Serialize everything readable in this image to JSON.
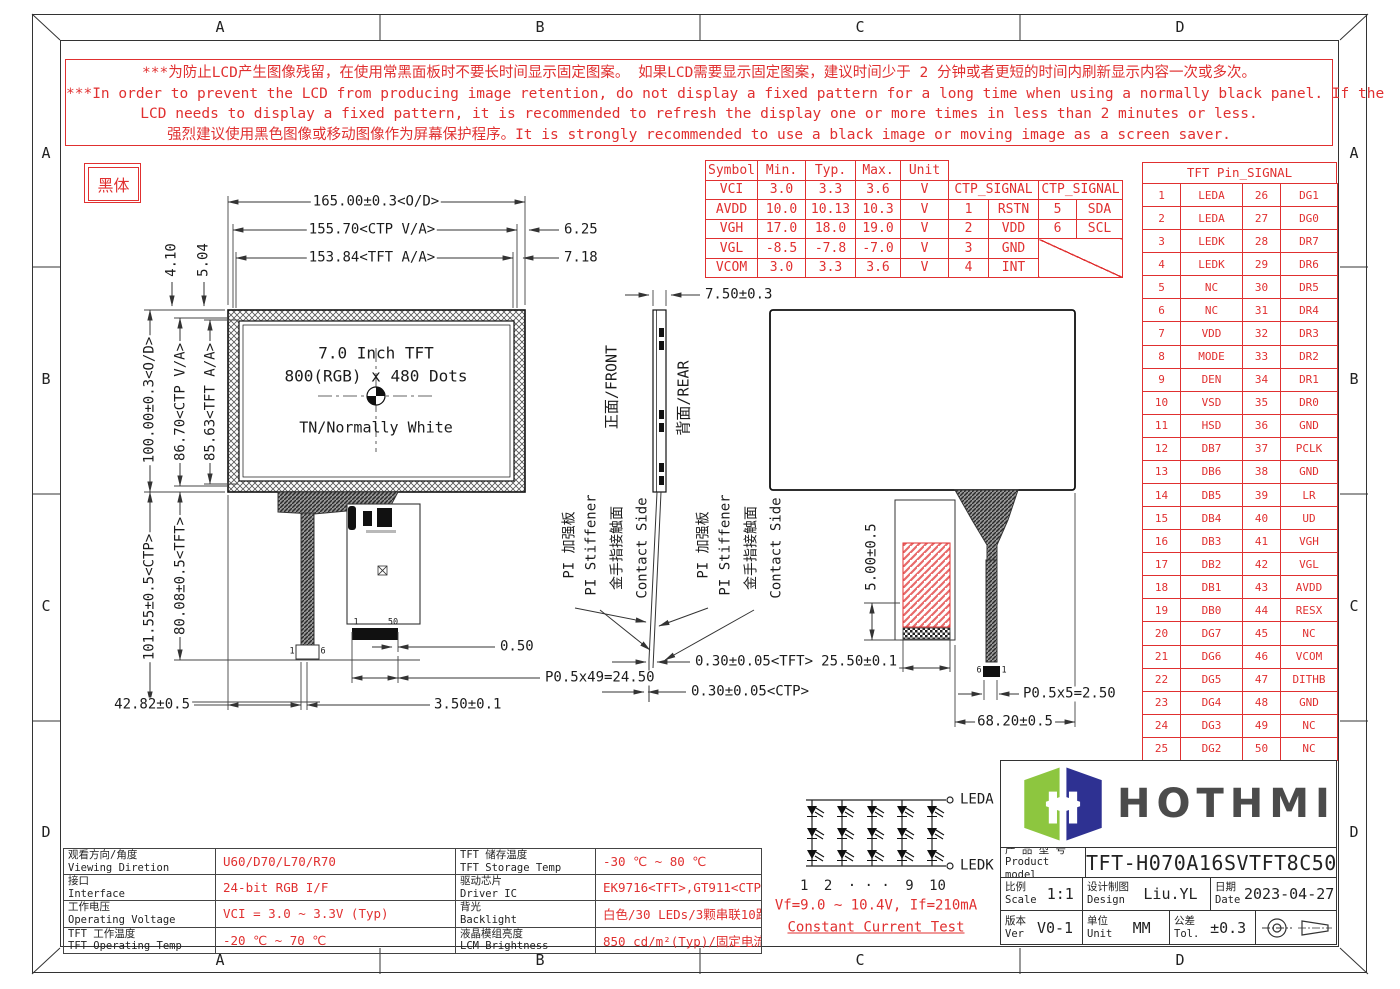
{
  "border": {
    "columns": [
      "A",
      "B",
      "C",
      "D"
    ],
    "rows": [
      "A",
      "B",
      "C",
      "D"
    ]
  },
  "warning": {
    "lines": [
      "***为防止LCD产生图像残留，在使用常黑面板时不要长时间显示固定图案。 如果LCD需要显示固定图案，建议时间少于 2 分钟或者更短的时间内刷新显示内容一次或多次。",
      "***In order to prevent the LCD from producing image retention, do not display a fixed pattern for a long time when using a normally black panel. If the",
      "LCD needs to display a fixed pattern, it is recommended to refresh the display one or more times in less than 2 minutes or less.",
      "强烈建议使用黑色图像或移动图像作为屏幕保护程序。It is strongly recommended to use a black image or moving image as a screen saver."
    ]
  },
  "note_box": "黑体",
  "front_view": {
    "line1": "7.0 Inch TFT",
    "line2": "800(RGB) x 480 Dots",
    "line3": "TN/Normally White"
  },
  "labels": {
    "front": "正面/FRONT",
    "rear": "背面/REAR",
    "stiffener_zh": "PI 加强板",
    "stiffener_en": "PI Stiffener",
    "contact_zh": "金手指接触面",
    "contact_en": "Contact Side"
  },
  "dims": {
    "od_w": "165.00±0.3<O/D>",
    "ctp_w": "155.70<CTP V/A>",
    "tft_w": "153.84<TFT A/A>",
    "off_ctp": "6.25",
    "off_tft": "7.18",
    "top_off1": "4.10",
    "top_off2": "5.04",
    "od_h": "100.00±0.3<O/D>",
    "ctp_h": "86.70<CTP V/A>",
    "tft_h": "85.63<TFT A/A>",
    "ctp_len": "101.55±0.5<CTP>",
    "tft_len": "80.08±0.5<TFT>",
    "fpc_x": "42.82±0.5",
    "fpc_off": "3.50±0.1",
    "pin_end": "0.50",
    "pitch_tft": "P0.5x49=24.50",
    "thick": "7.50±0.3",
    "tft_gap": "0.30±0.05<TFT>",
    "ctp_gap": "0.30±0.05<CTP>",
    "stiff_h": "5.00±0.5",
    "stiff_w": "25.50±0.1",
    "pitch_ctp": "P0.5x5=2.50",
    "fpc_rx": "68.20±0.5"
  },
  "pin_marks": {
    "ctp_left": "1",
    "ctp_right": "6",
    "tft_left": "1",
    "tft_right": "50",
    "rear_left": "6",
    "rear_right": "1"
  },
  "electrical_table": {
    "headers": [
      "Symbol",
      "Min.",
      "Typ.",
      "Max.",
      "Unit"
    ],
    "rows": [
      [
        "VCI",
        "3.0",
        "3.3",
        "3.6",
        "V"
      ],
      [
        "AVDD",
        "10.0",
        "10.13",
        "10.3",
        "V"
      ],
      [
        "VGH",
        "17.0",
        "18.0",
        "19.0",
        "V"
      ],
      [
        "VGL",
        "-8.5",
        "-7.8",
        "-7.0",
        "V"
      ],
      [
        "VCOM",
        "3.0",
        "3.3",
        "3.6",
        "V"
      ]
    ]
  },
  "ctp_table": {
    "header": "CTP_SIGNAL",
    "rows": [
      [
        "1",
        "RSTN",
        "5",
        "SDA"
      ],
      [
        "2",
        "VDD",
        "6",
        "SCL"
      ],
      [
        "3",
        "GND"
      ],
      [
        "4",
        "INT"
      ]
    ]
  },
  "pin_table": {
    "title": "TFT Pin_SIGNAL",
    "rows": [
      [
        "1",
        "LEDA",
        "26",
        "DG1"
      ],
      [
        "2",
        "LEDA",
        "27",
        "DG0"
      ],
      [
        "3",
        "LEDK",
        "28",
        "DR7"
      ],
      [
        "4",
        "LEDK",
        "29",
        "DR6"
      ],
      [
        "5",
        "NC",
        "30",
        "DR5"
      ],
      [
        "6",
        "NC",
        "31",
        "DR4"
      ],
      [
        "7",
        "VDD",
        "32",
        "DR3"
      ],
      [
        "8",
        "MODE",
        "33",
        "DR2"
      ],
      [
        "9",
        "DEN",
        "34",
        "DR1"
      ],
      [
        "10",
        "VSD",
        "35",
        "DR0"
      ],
      [
        "11",
        "HSD",
        "36",
        "GND"
      ],
      [
        "12",
        "DB7",
        "37",
        "PCLK"
      ],
      [
        "13",
        "DB6",
        "38",
        "GND"
      ],
      [
        "14",
        "DB5",
        "39",
        "LR"
      ],
      [
        "15",
        "DB4",
        "40",
        "UD"
      ],
      [
        "16",
        "DB3",
        "41",
        "VGH"
      ],
      [
        "17",
        "DB2",
        "42",
        "VGL"
      ],
      [
        "18",
        "DB1",
        "43",
        "AVDD"
      ],
      [
        "19",
        "DB0",
        "44",
        "RESX"
      ],
      [
        "20",
        "DG7",
        "45",
        "NC"
      ],
      [
        "21",
        "DG6",
        "46",
        "VCOM"
      ],
      [
        "22",
        "DG5",
        "47",
        "DITHB"
      ],
      [
        "23",
        "DG4",
        "48",
        "GND"
      ],
      [
        "24",
        "DG3",
        "49",
        "NC"
      ],
      [
        "25",
        "DG2",
        "50",
        "NC"
      ]
    ]
  },
  "spec_table": {
    "rows": [
      {
        "label_zh": "观看方向/角度",
        "label_en": "Viewing Diretion",
        "value": "U60/D70/L70/R70",
        "label2_zh": "TFT 储存温度",
        "label2_en": "TFT Storage Temp",
        "value2": "-30 ℃ ~ 80 ℃"
      },
      {
        "label_zh": "接口",
        "label_en": "Interface",
        "value": "24-bit RGB I/F",
        "label2_zh": "驱动芯片",
        "label2_en": "Driver IC",
        "value2": "EK9716<TFT>,GT911<CTP>"
      },
      {
        "label_zh": "工作电压",
        "label_en": "Operating Voltage",
        "value": "VCI = 3.0 ~ 3.3V (Typ)",
        "label2_zh": "背光",
        "label2_en": "Backlight",
        "value2": "白色/30 LEDs/3颗串联10路并联"
      },
      {
        "label_zh": "TFT 工作温度",
        "label_en": "TFT Operating Temp",
        "value": "-20 ℃ ~ 70 ℃",
        "label2_zh": "液晶模组亮度",
        "label2_en": "LCM Brightness",
        "value2": "850 cd/m²(Typ)/固定电流测试"
      }
    ]
  },
  "backlight": {
    "cols": [
      "1",
      "2",
      "· · ·",
      "9",
      "10"
    ],
    "leda": "LEDA",
    "ledk": "LEDK",
    "vf": "Vf=9.0 ~ 10.4V, If=210mA",
    "test": "Constant Current Test"
  },
  "title_block": {
    "brand": "HOTHMI",
    "product_label_zh": "产 品 型 号",
    "product_label_en": "Product model",
    "product_model": "TFT-H070A16SVTFT8C50",
    "scale_zh": "比例",
    "scale_en": "Scale",
    "scale": "1:1",
    "design_zh": "设计制图",
    "design_en": "Design",
    "designer": "Liu.YL",
    "date_zh": "日期",
    "date_en": "Date",
    "date": "2023-04-27",
    "ver_zh": "版本",
    "ver_en": "Ver",
    "version": "V0-1",
    "unit_zh": "单位",
    "unit_en": "Unit",
    "unit": "MM",
    "tol_zh": "公差",
    "tol_en": "Tol.",
    "tolerance": "±0.3"
  },
  "colors": {
    "accent_red": "#e03030",
    "line": "#333333",
    "logo_green": "#8dc63f",
    "logo_blue": "#2e3192"
  }
}
